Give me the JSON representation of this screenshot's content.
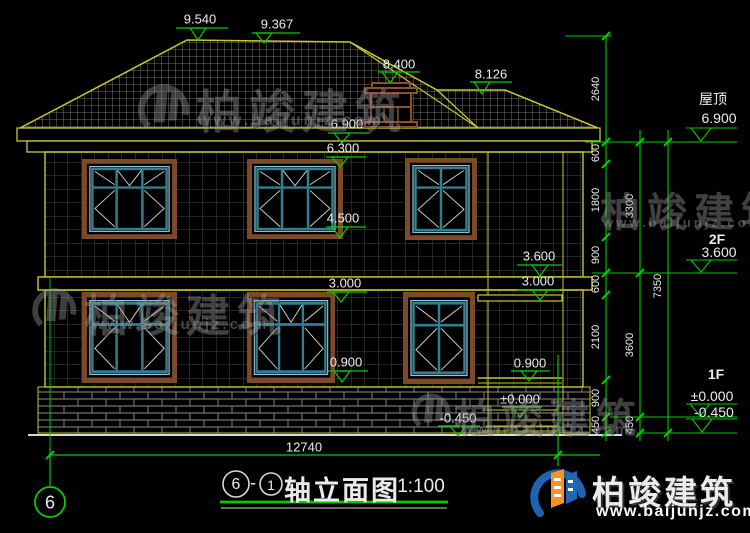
{
  "colors": {
    "background": "#000000",
    "wall_outline": "#c8c832",
    "marker_green": "#00cc00",
    "window_frame_brown": "#7a4a2a",
    "window_teal": "#2f8090",
    "logo_blue": "#1e62b0",
    "logo_orange": "#f7941d"
  },
  "markers": {
    "ridge_main": "9.540",
    "ridge_second": "9.367",
    "dormer_top": "8.400",
    "lower_ridge": "8.126",
    "eave_top": "6.900",
    "window_head_2f": "6.300",
    "window_sill_2f": "4.500",
    "floor_2f": "3.600",
    "ceiling_1f_mid": "3.000",
    "ceiling_1f_right": "3.000",
    "window_sill_1f": "0.900",
    "porch_sill": "0.900",
    "floor_1f": "±0.000",
    "ground": "-0.450"
  },
  "right_levels": {
    "roof_label": "屋顶",
    "roof_value": "6.900",
    "f2_label": "2F",
    "f2_value": "3.600",
    "f1_label": "1F",
    "f1_value": "±0.000",
    "ground_value": "-0.450"
  },
  "dimensions": {
    "chain_inner": [
      "2640",
      "600",
      "1800",
      "900",
      "600",
      "2100",
      "900",
      "450"
    ],
    "chain_middle": [
      "3300",
      "3600",
      "450"
    ],
    "chain_outer": [
      "7350"
    ],
    "overall_width": "12740"
  },
  "axis": {
    "bubble": "6"
  },
  "title_bar": {
    "axis_from": "6",
    "separator": "-",
    "axis_to": "1",
    "name": "轴立面图",
    "scale": "1:100"
  },
  "watermark": {
    "brand": "柏竣建筑",
    "url": "www.baijunjz.com"
  },
  "logo": {
    "brand": "柏竣建筑",
    "url": "www.baijunjz.com"
  }
}
